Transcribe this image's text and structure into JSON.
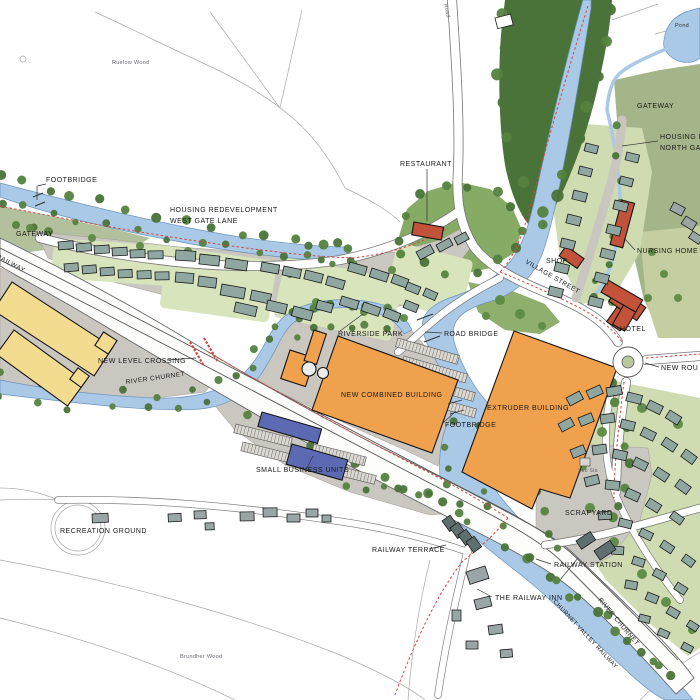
{
  "labels": {
    "ruelow_wood": "Ruelow Wood",
    "road_top": "Road",
    "pond": "Pond",
    "footbridge_nw": "FOOTBRIDGE",
    "gateway_w": "GATEWAY",
    "housing_west_line1": "HOUSING REDEVELOPMENT",
    "housing_west_line2": "WEST GATE LANE",
    "valley_railway": "VALLEY RAILWAY",
    "new_level_crossing": "NEW LEVEL CROSSING",
    "river_churnet_w": "RIVER CHURNET",
    "riverside_park": "RIVERSIDE PARK",
    "road_bridge": "ROAD BRIDGE",
    "new_combined_building": "NEW COMBINED BUILDING",
    "footbridge_c": "FOOTBRIDGE",
    "extruder_building": "EXTRUDER BUILDING",
    "small_business_units": "SMALL BUSINESS UNITS",
    "recreation_ground": "RECREATION GROUND",
    "railway_terrace": "RAILWAY TERRACE",
    "railway_station": "RAILWAY STATION",
    "the_railway_inn": "THE RAILWAY INN",
    "scrapyard": "SCRAPYARD",
    "sub_sta": "Sub Sta",
    "river_churnet_se": "RIVER CHURNET",
    "churnet_valley_railway": "CHURNET VALLEY RAILWAY",
    "gateway_ne": "GATEWAY",
    "housing_north_line1": "HOUSING RE",
    "housing_north_line2": "NORTH GATE",
    "nursing_home": "NURSING HOME",
    "shop": "SHOP",
    "village_street": "VILLAGE STREET",
    "hotel": "HOTEL",
    "restaurant": "RESTAURANT",
    "new_road": "NEW ROU",
    "wood_sw": "Brundher Wood"
  },
  "colors": {
    "water": "#a9c9e6",
    "water_edge": "#6b93bd",
    "wood": "#4a7339",
    "grass": "#a4b689",
    "grass_light": "#cfdcb2",
    "estate_green": "#86ab64",
    "platform": "#cac6c0",
    "road_casing": "#777777",
    "path_red": "#cc4a44",
    "bldg_orange": "#f0a14e",
    "bldg_yellow": "#f3dc90",
    "bldg_blue": "#5c6ab4",
    "bldg_red": "#c25239",
    "house": "#8fa7a0",
    "house_dark": "#5d6f6f",
    "ink": "#191919"
  }
}
